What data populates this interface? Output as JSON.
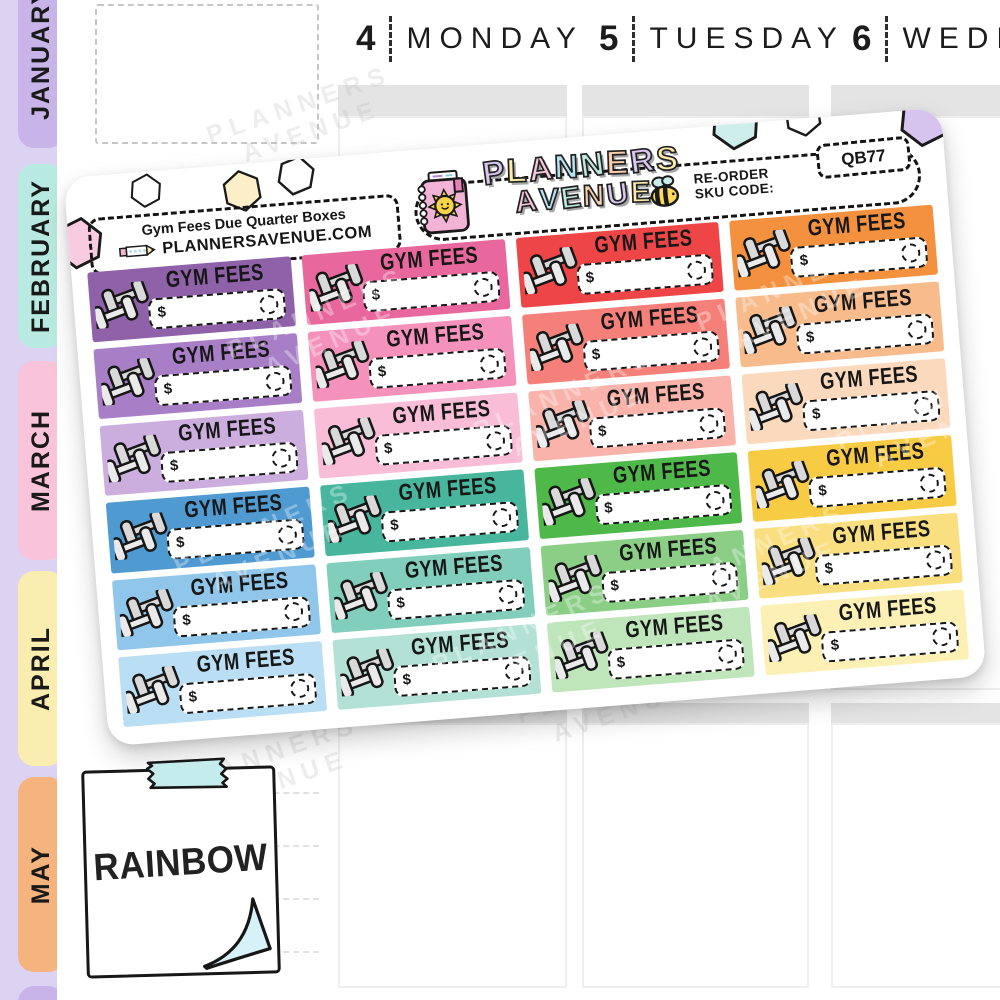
{
  "planner": {
    "months": [
      "JANUARY",
      "FEBRUARY",
      "MARCH",
      "APRIL",
      "MAY"
    ],
    "days": [
      {
        "number": "4",
        "name": "MONDAY"
      },
      {
        "number": "5",
        "name": "TUESDAY"
      },
      {
        "number": "6",
        "name": "WEDNESDAY"
      }
    ]
  },
  "sheet": {
    "label_title": "Gym Fees Due Quarter Boxes",
    "website": "PLANNERSAVENUE.COM",
    "brand_line1": "PLANNERS",
    "brand_line2": "AVENUE",
    "reorder_line1": "RE-ORDER",
    "reorder_line2": "SKU CODE:",
    "sku_code": "QB77",
    "box_label": "GYM FEES",
    "currency_symbol": "$",
    "watermark_line1": "PLANNERS",
    "watermark_line2": "AVENUE",
    "grid_rows": [
      [
        "#8e61a8",
        "#e8679c",
        "#ee4646",
        "#f3913f"
      ],
      [
        "#a87fc6",
        "#f492bb",
        "#f5807a",
        "#f8bc8c"
      ],
      [
        "#cbaede",
        "#f9bdd7",
        "#f9b3ab",
        "#fbd9bd"
      ],
      [
        "#4f9ad1",
        "#47b69d",
        "#4eb849",
        "#f8cb44"
      ],
      [
        "#90c6e9",
        "#81cebc",
        "#8bce86",
        "#fadf81"
      ],
      [
        "#badef3",
        "#b4e1d5",
        "#bfe5ba",
        "#fcf0b4"
      ]
    ]
  },
  "note": {
    "text": "RAINBOW"
  },
  "colors": {
    "side_strip": "#dcd2f1",
    "tab_january": "#c8b4e8",
    "tab_february": "#b9eae2",
    "tab_march": "#f9c4da",
    "tab_april": "#faedb0",
    "tab_may": "#f5b37e",
    "tab_extra": "#c8b4e8",
    "header_bar": "#e4e4e4",
    "logo_lavender": "#d9c6f0",
    "logo_yellow": "#fceba9",
    "logo_pink": "#f8c7dd",
    "logo_blue": "#b5e3f2",
    "logo_teal": "#bdeadf",
    "logo_peach": "#f9cfae",
    "tape": "#c5ecec",
    "curl": "#d6f1f7"
  }
}
